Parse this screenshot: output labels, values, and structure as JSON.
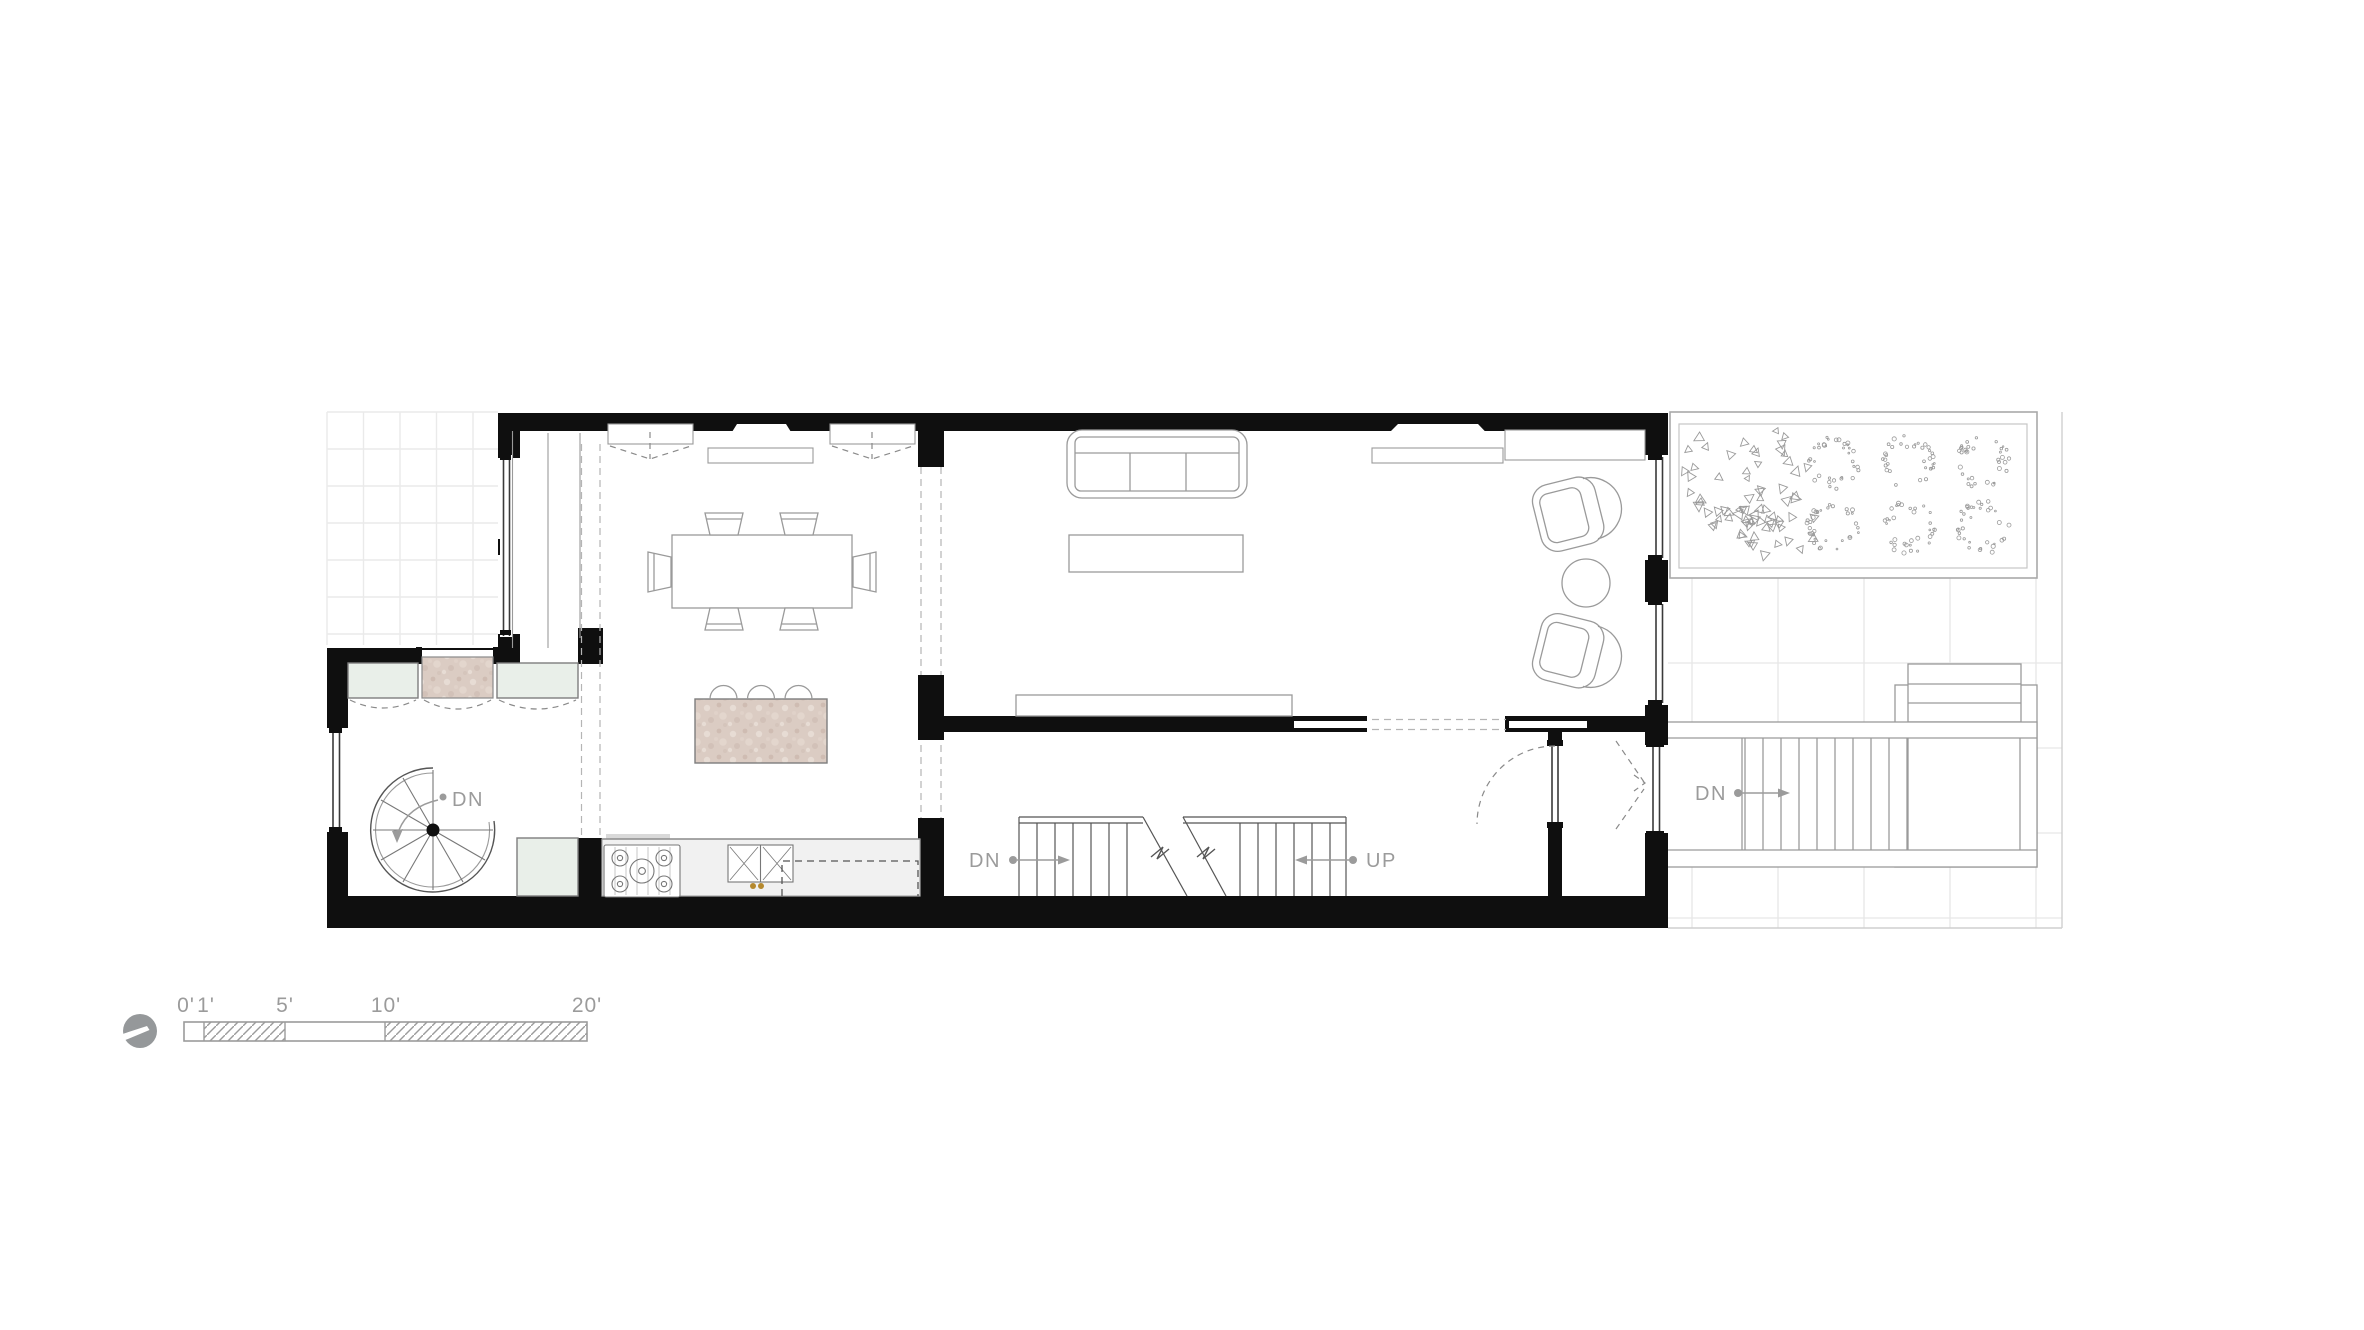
{
  "plan": {
    "labels": {
      "spiral_stair_down": "DN",
      "basement_stair_down": "DN",
      "main_stair_up": "UP",
      "garden_stair_down": "DN"
    }
  },
  "scale_bar": {
    "ticks": [
      {
        "label": "0'"
      },
      {
        "label": "1'"
      },
      {
        "label": "5'"
      },
      {
        "label": "10'"
      },
      {
        "label": "20'"
      }
    ]
  },
  "colors": {
    "wall_black": "#0f0f0f",
    "annotation_gray": "#9b9b9b",
    "stone_pink": "#dbccc3",
    "glass_green": "#e9efe9",
    "counter_gray": "#f1f1f1",
    "drawing_line_gray": "#8f8f8f",
    "grid_gray": "#e8e8e8",
    "north_icon_gray": "#95989a"
  },
  "icons": {
    "north_arrow": "north-arrow-icon"
  }
}
